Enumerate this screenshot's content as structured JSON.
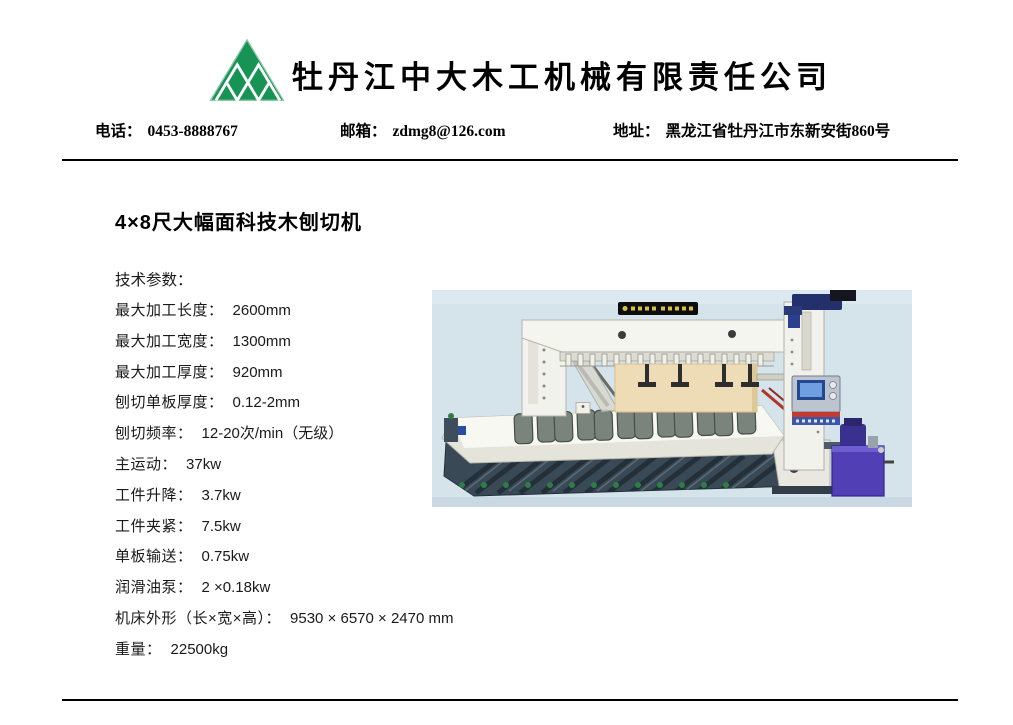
{
  "header": {
    "company_name": "牡丹江中大木工机械有限责任公司",
    "logo": {
      "icon": "triangle-diamond-logo-icon",
      "color": "#169355"
    },
    "contact": {
      "phone_label": "电话：",
      "phone_value": "0453-8888767",
      "email_label": "邮箱：",
      "email_value": "zdmg8@126.com",
      "address_label": "地址：",
      "address_value": "黑龙江省牡丹江市东新安街860号"
    }
  },
  "product": {
    "title": "4×8尺大幅面科技木刨切机",
    "specs_heading": "技术参数：",
    "specs": [
      {
        "label": "最大加工长度：",
        "value": "2600mm"
      },
      {
        "label": "最大加工宽度：",
        "value": "1300mm"
      },
      {
        "label": "最大加工厚度：",
        "value": "920mm"
      },
      {
        "label": "刨切单板厚度：",
        "value": "0.12-2mm"
      },
      {
        "label": "刨切频率：",
        "value": "12-20次/min（无级）"
      },
      {
        "label": "主运动：",
        "value": "37kw"
      },
      {
        "label": "工件升降：",
        "value": "3.7kw"
      },
      {
        "label": "工件夹紧：",
        "value": "7.5kw"
      },
      {
        "label": "单板输送：",
        "value": "0.75kw"
      },
      {
        "label": "润滑油泵：",
        "value": "2 ×0.18kw"
      },
      {
        "label": "机床外形（长×宽×高）：",
        "value": "9530 × 6570 × 2470 mm"
      },
      {
        "label": "重量：",
        "value": "22500kg"
      }
    ]
  },
  "photo": {
    "description": "gantry-veneer-slicing-machine-photo",
    "background_color": "#d5e3eb",
    "machine_body_color": "#f2f2ec",
    "base_color": "#394956",
    "board_color": "#eddcb5",
    "hydraulic_unit_color": "#5140b5"
  }
}
